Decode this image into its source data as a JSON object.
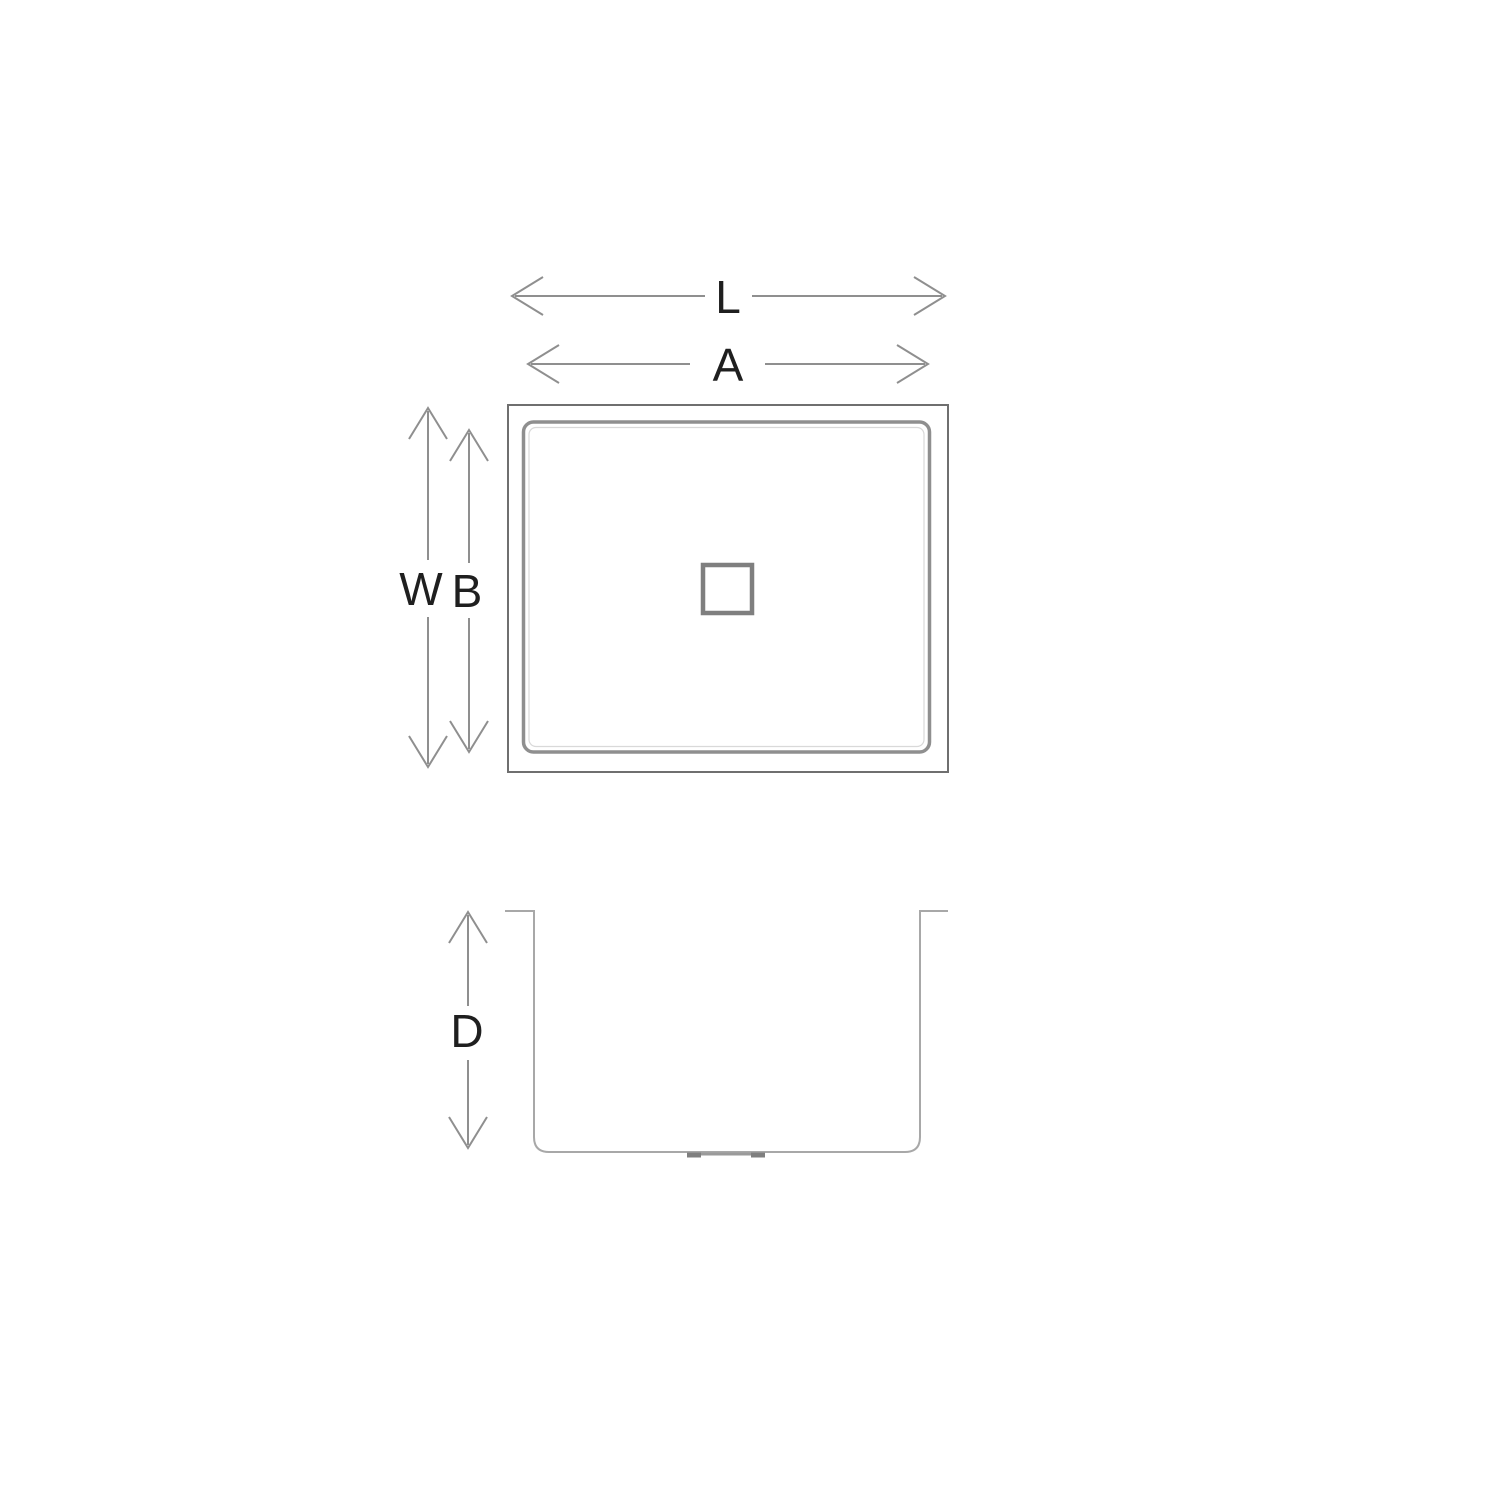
{
  "canvas": {
    "width": 1500,
    "height": 1500,
    "background": "#ffffff"
  },
  "colors": {
    "label_text": "#1f1f1f",
    "outer_outline": "#6f6f6f",
    "inner_outline": "#8f8f8f",
    "inner_highlight": "#d9d9d9",
    "drain_outline": "#7f7f7f",
    "dim_line": "#8f8f8f",
    "section_line": "#a8a8a8",
    "section_drain_mark": "#7f7f7f"
  },
  "dimension_labels": {
    "overall_length": "L",
    "basin_length": "A",
    "overall_width": "W",
    "basin_width": "B",
    "basin_depth": "D"
  }
}
